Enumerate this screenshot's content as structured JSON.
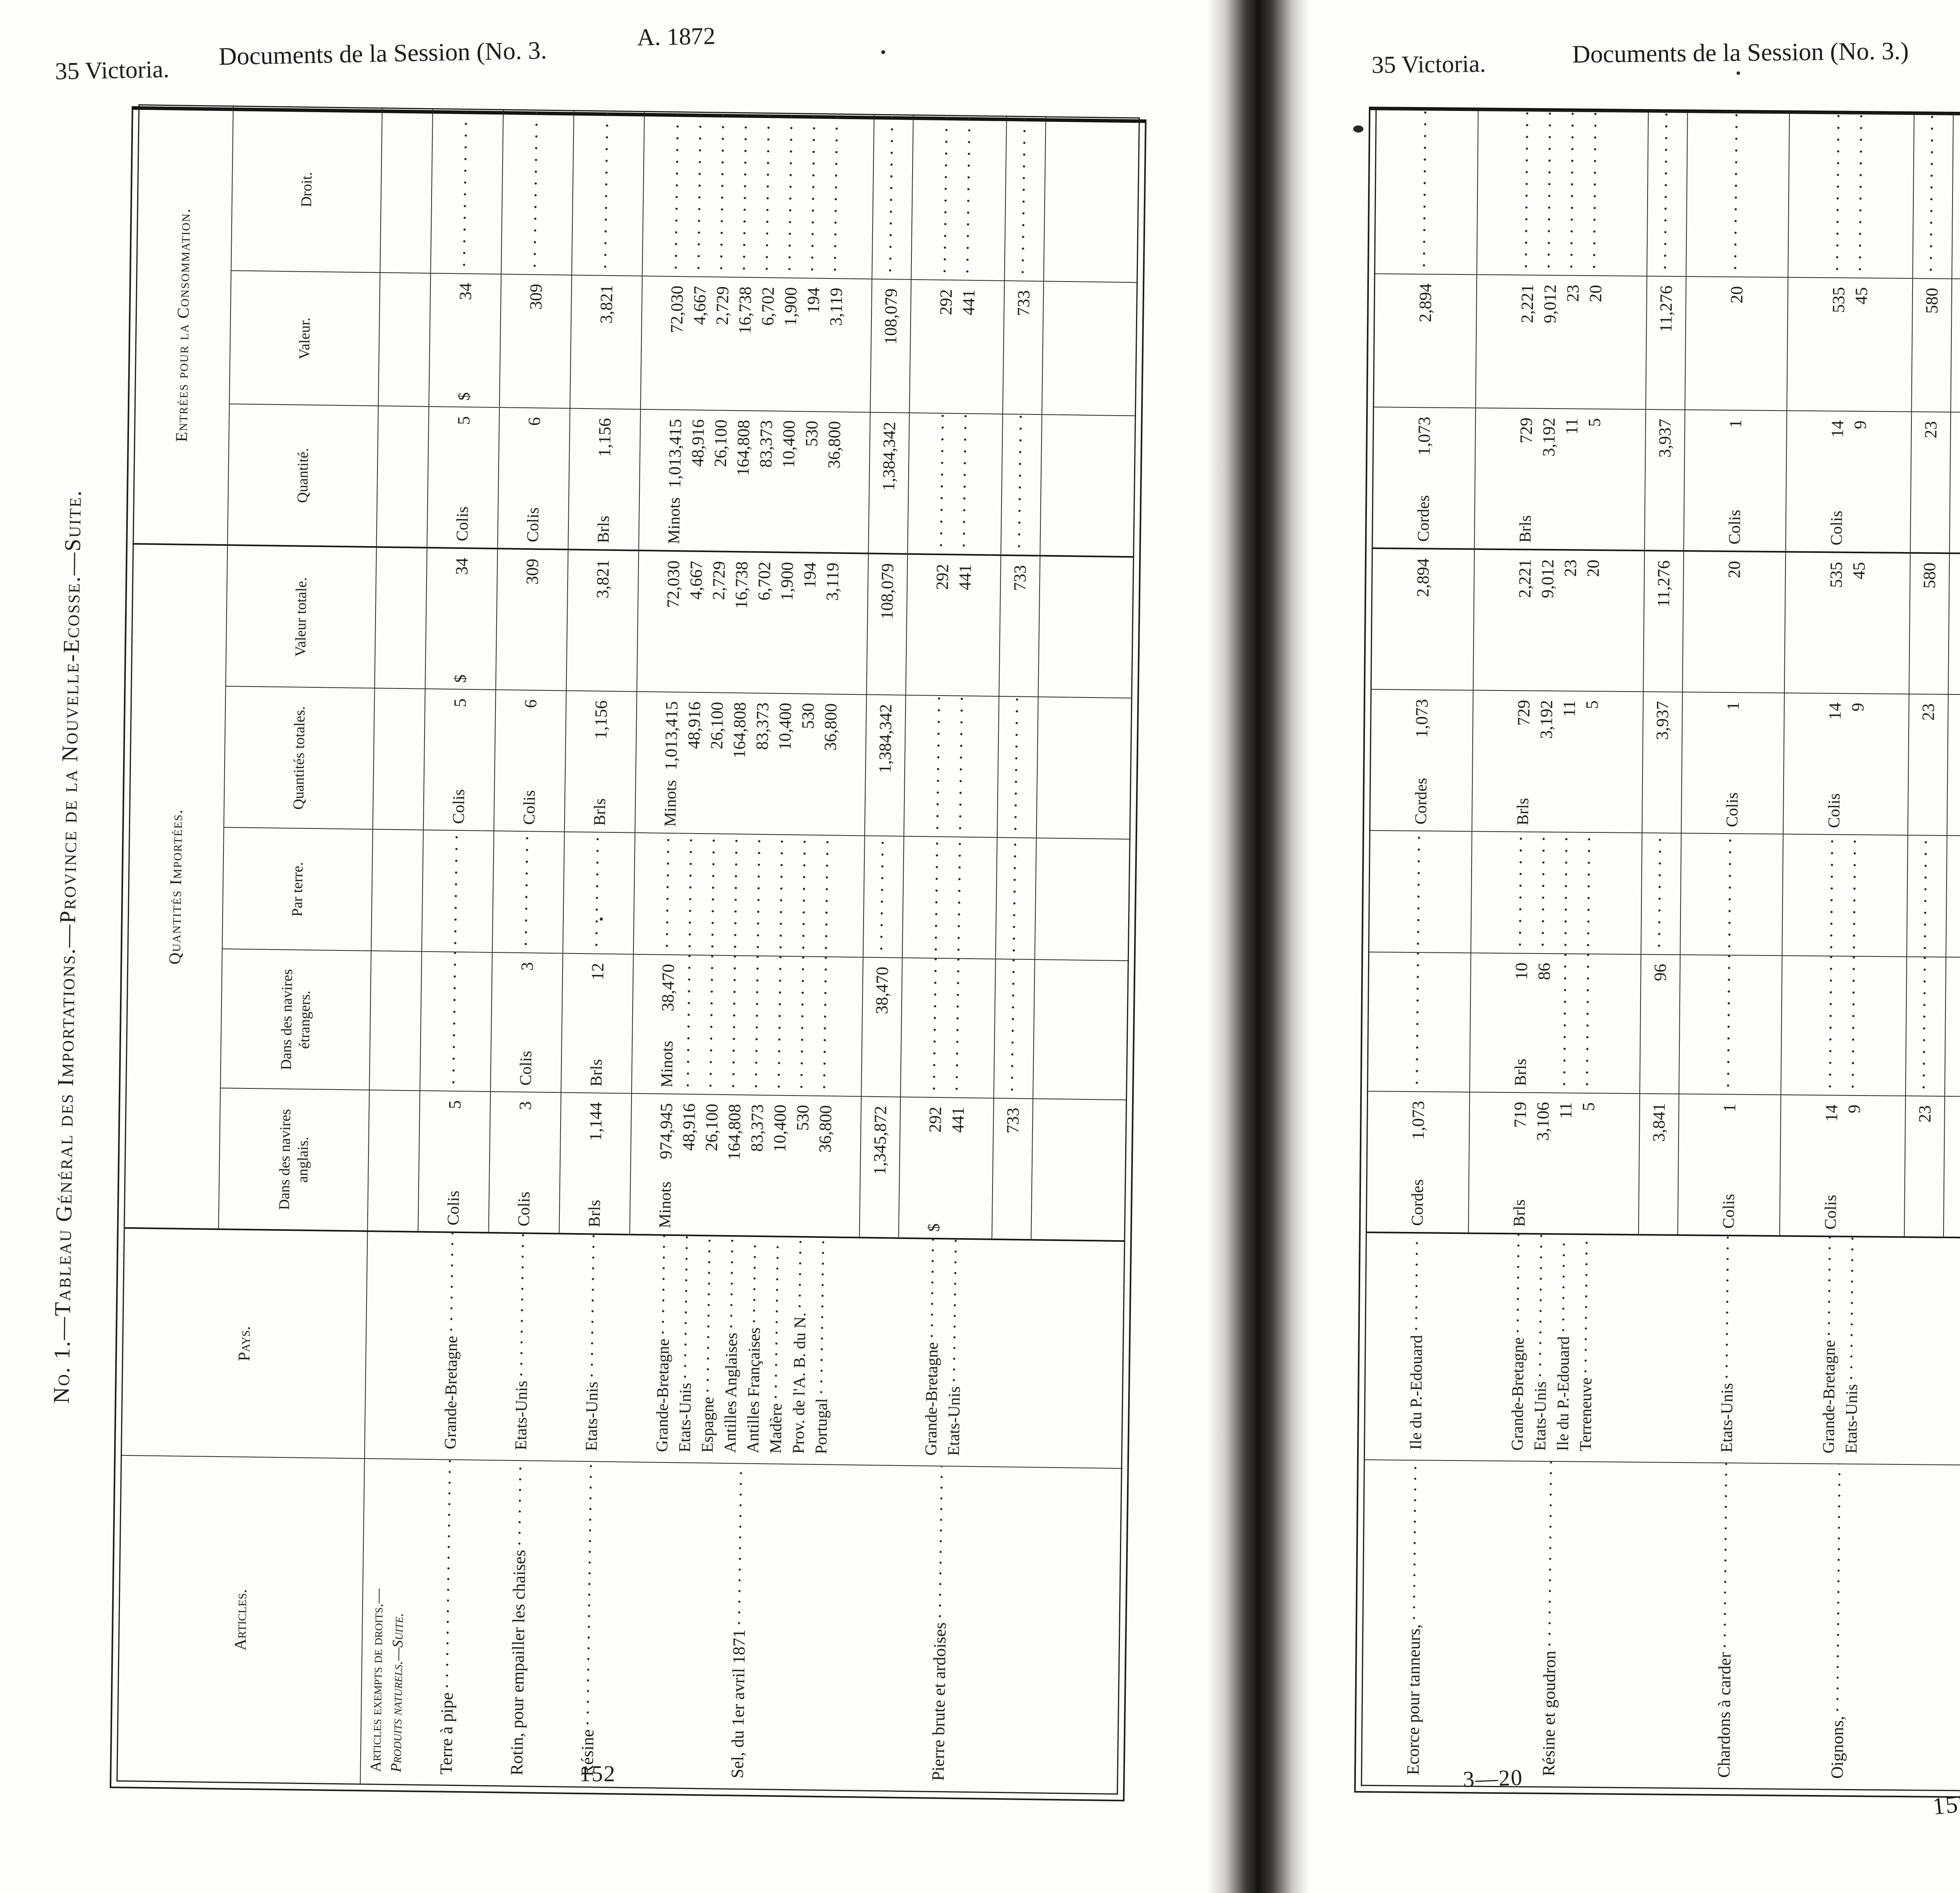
{
  "left_page": {
    "running_head": {
      "left": "35 Victoria.",
      "center": "Documents de la Session (No. 3.",
      "right": "A. 1872"
    },
    "side_title": "No. 1.—Tableau Général des Importations.—Province de la Nouvelle-Ecosse.—Suite.",
    "page_number": "152",
    "table": {
      "group_headers": {
        "imports": "Quantités Importées.",
        "consumption": "Entrées pour la Consommation."
      },
      "columns": {
        "articles": "Articles.",
        "pays": "Pays.",
        "anglais": "Dans des navires anglais.",
        "etrangers": "Dans des navires étrangers.",
        "terre": "Par terre.",
        "qtotales": "Quantités totales.",
        "vtotale": "Valeur totale.",
        "quantite": "Quantité.",
        "valeur": "Valeur.",
        "droit": "Droit."
      },
      "blocks": [
        {
          "t": "h",
          "lines": [
            "Articles exempts de droits.—",
            "Produits naturels.—Suite."
          ]
        },
        {
          "t": "d",
          "article": "Terre à pipe",
          "pays": [
            "Grande-Bretagne"
          ],
          "cells": {
            "anglais": {
              "u": "Colis",
              "v": [
                "5"
              ]
            },
            "qtotales": {
              "u": "Colis",
              "v": [
                "5"
              ]
            },
            "vtotale": {
              "u": "$",
              "v": [
                "34"
              ]
            },
            "quantite": {
              "u": "Colis",
              "v": [
                "5"
              ]
            },
            "valeur": {
              "u": "$",
              "v": [
                "34"
              ]
            }
          }
        },
        {
          "t": "d",
          "article": "Rotin, pour empailler les chaises",
          "pays": [
            "Etats-Unis"
          ],
          "cells": {
            "anglais": {
              "u": "Colis",
              "v": [
                "3"
              ]
            },
            "etrangers": {
              "u": "Colis",
              "v": [
                "3"
              ]
            },
            "qtotales": {
              "u": "Colis",
              "v": [
                "6"
              ]
            },
            "vtotale": {
              "v": [
                "309"
              ]
            },
            "quantite": {
              "u": "Colis",
              "v": [
                "6"
              ]
            },
            "valeur": {
              "v": [
                "309"
              ]
            }
          }
        },
        {
          "t": "d",
          "article": "Résine",
          "pays": [
            "Etats-Unis"
          ],
          "cells": {
            "anglais": {
              "u": "Brls",
              "v": [
                "1,144"
              ]
            },
            "etrangers": {
              "u": "Brls",
              "v": [
                "12"
              ]
            },
            "qtotales": {
              "u": "Brls",
              "v": [
                "1,156"
              ]
            },
            "vtotale": {
              "v": [
                "3,821"
              ]
            },
            "quantite": {
              "u": "Brls",
              "v": [
                "1,156"
              ]
            },
            "valeur": {
              "v": [
                "3,821"
              ]
            }
          }
        },
        {
          "t": "d",
          "article": "Sel, du 1er avril 1871",
          "pays": [
            "Grande-Bretagne",
            "Etats-Unis",
            "Espagne",
            "Antilles Anglaises",
            "Antilles Françaises",
            "Madère",
            "Prov. de l'A. B. du N.",
            "Portugal"
          ],
          "cells": {
            "anglais": {
              "u": "Minots",
              "v": [
                "974,945",
                "48,916",
                "26,100",
                "164,808",
                "83,373",
                "10,400",
                "530",
                "36,800"
              ]
            },
            "etrangers": {
              "u": "Minots",
              "v": [
                "38,470",
                null,
                null,
                null,
                null,
                null,
                null,
                null
              ]
            },
            "qtotales": {
              "u": "Minots",
              "v": [
                "1,013,415",
                "48,916",
                "26,100",
                "164,808",
                "83,373",
                "10,400",
                "530",
                "36,800"
              ]
            },
            "vtotale": {
              "v": [
                "72,030",
                "4,667",
                "2,729",
                "16,738",
                "6,702",
                "1,900",
                "194",
                "3,119"
              ]
            },
            "quantite": {
              "u": "Minots",
              "v": [
                "1,013,415",
                "48,916",
                "26,100",
                "164,808",
                "83,373",
                "10,400",
                "530",
                "36,800"
              ]
            },
            "valeur": {
              "v": [
                "72,030",
                "4,667",
                "2,729",
                "16,738",
                "6,702",
                "1,900",
                "194",
                "3,119"
              ]
            }
          }
        },
        {
          "t": "t",
          "cells": {
            "anglais": "1,345,872",
            "etrangers": "38,470",
            "qtotales": "1,384,342",
            "vtotale": "108,079",
            "quantite": "1,384,342",
            "valeur": "108,079"
          }
        },
        {
          "t": "d",
          "article": "Pierre brute et ardoises",
          "pays": [
            "Grande-Bretagne",
            "Etats-Unis"
          ],
          "cells": {
            "anglais": {
              "u": "$",
              "v": [
                "292",
                "441"
              ]
            },
            "vtotale": {
              "v": [
                "292",
                "441"
              ]
            },
            "valeur": {
              "v": [
                "292",
                "441"
              ]
            }
          }
        },
        {
          "t": "t",
          "cells": {
            "anglais": "733",
            "vtotale": "733",
            "valeur": "733"
          }
        },
        {
          "t": "s"
        }
      ]
    }
  },
  "right_page": {
    "running_head": {
      "left": "35 Victoria.",
      "center": "Documents de la Session (No. 3.)",
      "right": "A. 1872"
    },
    "signature_mark": "3—20",
    "page_number": "153",
    "table": {
      "blocks": [
        {
          "t": "d",
          "article": "Ecorce pour tanneurs,",
          "pays": [
            "Ile du P.-Edouard"
          ],
          "cells": {
            "anglais": {
              "u": "Cordes",
              "v": [
                "1,073"
              ]
            },
            "qtotales": {
              "u": "Cordes",
              "v": [
                "1,073"
              ]
            },
            "vtotale": {
              "v": [
                "2,894"
              ]
            },
            "quantite": {
              "u": "Cordes",
              "v": [
                "1,073"
              ]
            },
            "valeur": {
              "v": [
                "2,894"
              ]
            }
          }
        },
        {
          "t": "d",
          "article": "Résine et goudron",
          "pays": [
            "Grande-Bretagne",
            "Etats-Unis",
            "Ile du P.-Edouard",
            "Terreneuve"
          ],
          "cells": {
            "anglais": {
              "u": "Brls",
              "v": [
                "719",
                "3,106",
                "11",
                "5"
              ]
            },
            "etrangers": {
              "u": "Brls",
              "v": [
                "10",
                "86",
                null,
                null
              ]
            },
            "qtotales": {
              "u": "Brls",
              "v": [
                "729",
                "3,192",
                "11",
                "5"
              ]
            },
            "vtotale": {
              "v": [
                "2,221",
                "9,012",
                "23",
                "20"
              ]
            },
            "quantite": {
              "u": "Brls",
              "v": [
                "729",
                "3,192",
                "11",
                "5"
              ]
            },
            "valeur": {
              "v": [
                "2,221",
                "9,012",
                "23",
                "20"
              ]
            }
          }
        },
        {
          "t": "t",
          "cells": {
            "anglais": "3,841",
            "etrangers": "96",
            "qtotales": "3,937",
            "vtotale": "11,276",
            "quantite": "3,937",
            "valeur": "11,276"
          }
        },
        {
          "t": "d",
          "article": "Chardons à carder",
          "pays": [
            "Etats-Unis"
          ],
          "cells": {
            "anglais": {
              "u": "Colis",
              "v": [
                "1"
              ]
            },
            "qtotales": {
              "u": "Colis",
              "v": [
                "1"
              ]
            },
            "vtotale": {
              "v": [
                "20"
              ]
            },
            "quantite": {
              "u": "Colis",
              "v": [
                "1"
              ]
            },
            "valeur": {
              "v": [
                "20"
              ]
            }
          }
        },
        {
          "t": "d",
          "article": "Oignons,",
          "pays": [
            "Grande-Bretagne",
            "Etats-Unis"
          ],
          "cells": {
            "anglais": {
              "u": "Colis",
              "v": [
                "14",
                "9"
              ]
            },
            "qtotales": {
              "u": "Colis",
              "v": [
                "14",
                "9"
              ]
            },
            "vtotale": {
              "v": [
                "535",
                "45"
              ]
            },
            "quantite": {
              "u": "Colis",
              "v": [
                "14",
                "9"
              ]
            },
            "valeur": {
              "v": [
                "535",
                "45"
              ]
            }
          }
        },
        {
          "t": "t",
          "cells": {
            "anglais": "23",
            "qtotales": "23",
            "vtotale": "580",
            "quantite": "23",
            "valeur": "580"
          }
        },
        {
          "t": "d",
          "article": "Blé, depuis le 1er avril 1871",
          "pays": [
            "Etats-Unis"
          ],
          "cells": {
            "anglais": {
              "u": "Minots",
              "v": [
                "282"
              ]
            },
            "qtotales": {
              "u": "Minots",
              "v": [
                "282"
              ]
            },
            "vtotale": {
              "v": [
                "292"
              ]
            },
            "quantite": {
              "u": "Minots",
              "v": [
                "282"
              ]
            },
            "valeur": {
              "v": [
                "292"
              ]
            }
          }
        },
        {
          "t": "d",
          "article": "Bois—non ouvré",
          "pays": [
            "Grande-Bretagne",
            "Etats-Unis",
            "Antilles Anglaises"
          ],
          "cells": {
            "anglais": {
              "u": "$",
              "v": [
                "63",
                "4,694",
                "17"
              ]
            },
            "vtotale": {
              "v": [
                "63",
                "4,694",
                "17"
              ]
            },
            "valeur": {
              "v": [
                "63",
                "4,694",
                "17"
              ]
            }
          }
        },
        {
          "t": "t",
          "cells": {
            "anglais": "4,774",
            "vtotale": "4,774",
            "valeur": "4,774"
          }
        },
        {
          "t": "d",
          "article": "Laine",
          "pays": [
            "Grande-Bretagne",
            "Antilles Anglaises",
            "Antilles Espagnoles"
          ],
          "cells": {
            "anglais": {
              "u": "Lbs",
              "v": [
                "4,826",
                "9,642",
                "48"
              ]
            },
            "qtotales": {
              "u": "Lbs",
              "v": [
                "4,826",
                "9,642",
                "48"
              ]
            },
            "vtotale": {
              "v": [
                "602",
                "1,147",
                "192"
              ]
            },
            "quantite": {
              "u": "Lbs",
              "v": [
                "4,826",
                "9,642",
                "48"
              ]
            },
            "valeur": {
              "v": [
                "602",
                "1,147",
                "192"
              ]
            }
          }
        },
        {
          "t": "t",
          "cells": {
            "anglais": "14,516",
            "qtotales": "14,516",
            "vtotale": "1,941",
            "quantite": "14,516",
            "valeur": "1,941"
          }
        }
      ]
    }
  }
}
